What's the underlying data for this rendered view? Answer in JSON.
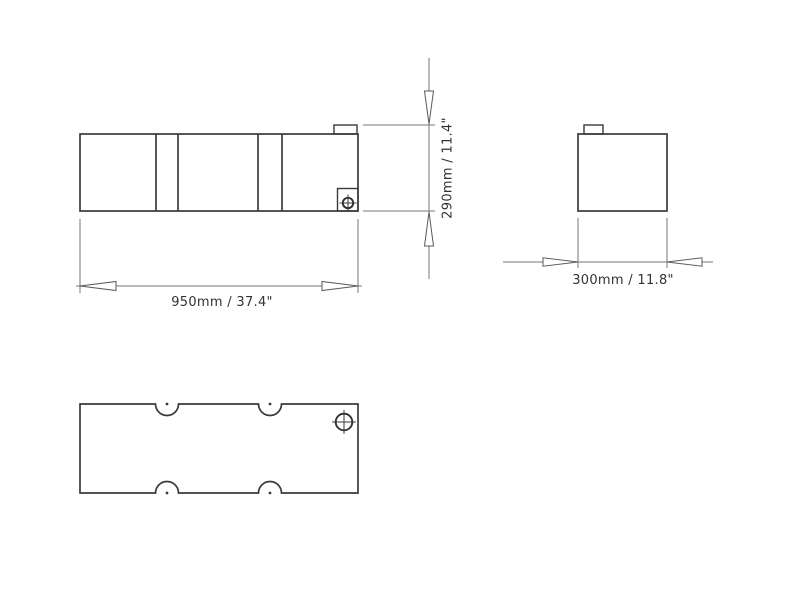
{
  "drawing": {
    "type": "technical-drawing",
    "background_color": "#ffffff",
    "outline_color": "#3a3a3a",
    "dimension_line_color": "#767676",
    "text_color": "#333333",
    "dimensions": {
      "length": "950mm / 37.4\"",
      "height": "290mm / 11.4\"",
      "depth": "300mm / 11.8\""
    },
    "icons": {
      "front_drain": "crosshair-fitting-icon",
      "top_fitting": "crosshair-fitting-icon"
    }
  }
}
